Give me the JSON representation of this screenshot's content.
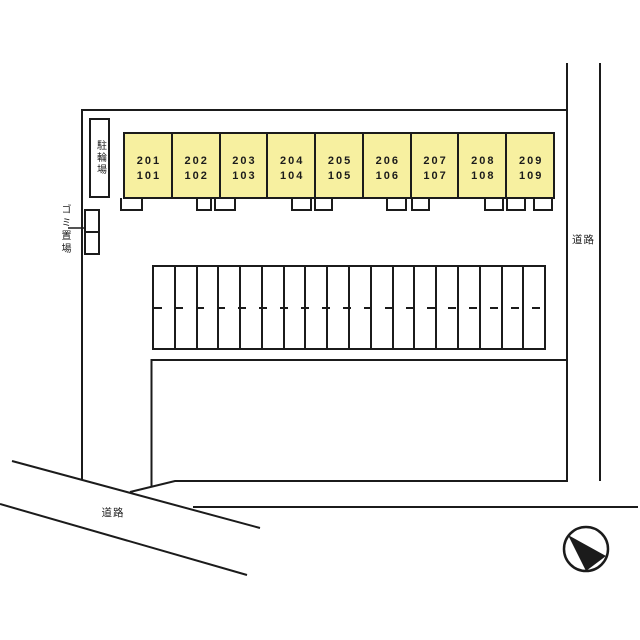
{
  "plan": {
    "building": {
      "units": [
        {
          "upper": "201",
          "lower": "101"
        },
        {
          "upper": "202",
          "lower": "102"
        },
        {
          "upper": "203",
          "lower": "103"
        },
        {
          "upper": "204",
          "lower": "104"
        },
        {
          "upper": "205",
          "lower": "105"
        },
        {
          "upper": "206",
          "lower": "106"
        },
        {
          "upper": "207",
          "lower": "107"
        },
        {
          "upper": "208",
          "lower": "108"
        },
        {
          "upper": "209",
          "lower": "109"
        }
      ]
    },
    "parking": {
      "stall_count": 18
    },
    "labels": {
      "bicycle_parking": "駐輪場",
      "garbage_area": "ゴミ置場",
      "road_right": "道路",
      "road_bottom": "道路"
    },
    "colors": {
      "unit_fill": "#f7f0a0",
      "line": "#1b1b1b",
      "background": "#ffffff"
    }
  }
}
